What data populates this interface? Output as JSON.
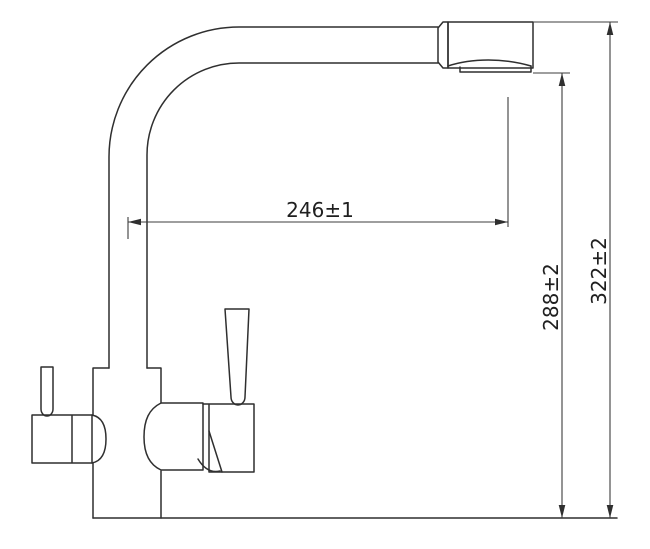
{
  "dimensions": {
    "reach": "246±1",
    "outlet_height": "288±2",
    "overall_height": "322±2"
  },
  "colors": {
    "line": "#2f2f2f",
    "dimension_line": "#3c3c3c",
    "label_text": "#1f1f1f",
    "background": "#ffffff"
  }
}
